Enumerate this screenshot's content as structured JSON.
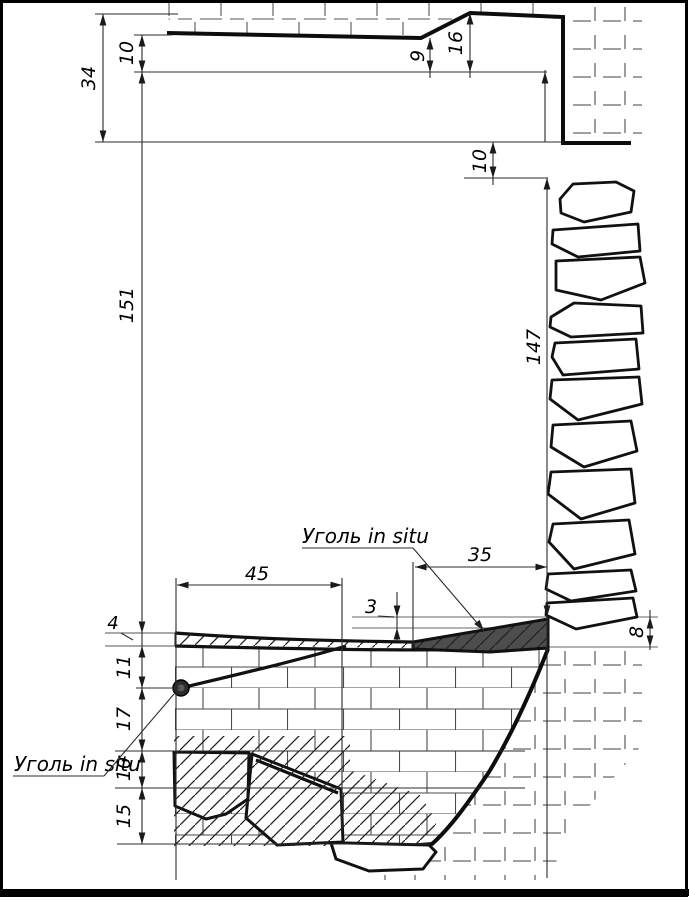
{
  "drawing": {
    "type": "geological-cross-section",
    "annotations": {
      "coal_in_situ_upper": "Уголь in situ",
      "coal_in_situ_lower": "Уголь in situ"
    },
    "dimensions": {
      "d34": "34",
      "d10_top": "10",
      "d9": "9",
      "d16": "16",
      "d10_right": "10",
      "d151": "151",
      "d147": "147",
      "d45": "45",
      "d35": "35",
      "d3": "3",
      "d8": "8",
      "d4": "4",
      "d11": "11",
      "d17": "17",
      "d10_low": "10",
      "d15": "15"
    },
    "colors": {
      "line": "#111111",
      "coal_fill": "#4d4d4d",
      "reference_line": "#9a9a9a",
      "background": "#ffffff"
    }
  }
}
